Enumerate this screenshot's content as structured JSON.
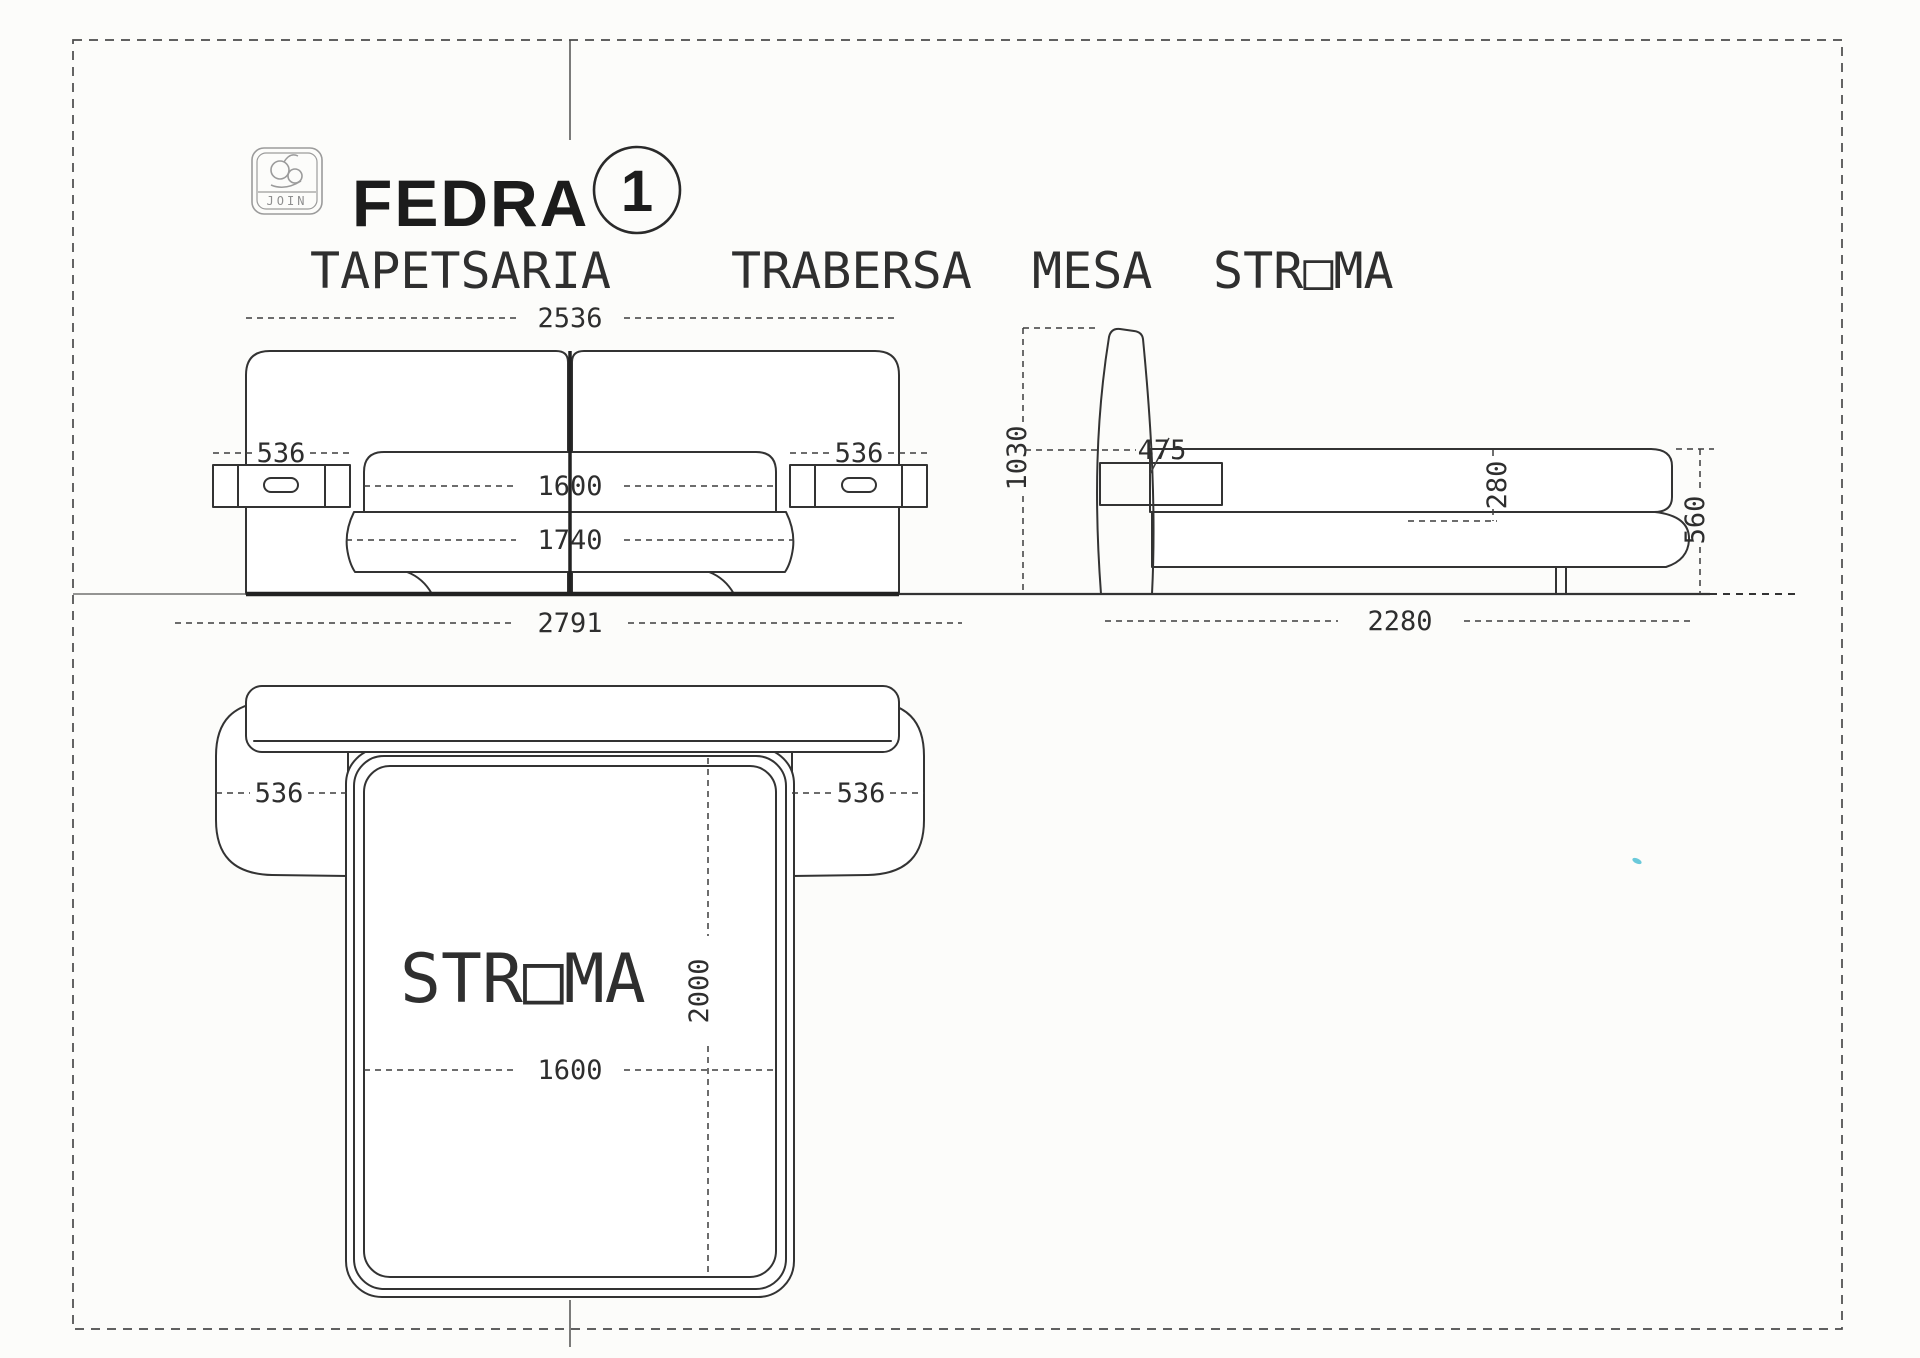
{
  "page": {
    "background": "#fcfcfa",
    "line_color": "#333333"
  },
  "title": {
    "product": "FEDRA",
    "variant_number": "1",
    "logo_brand": "JOIN"
  },
  "subtitle": {
    "word1": "TAPETSARIA",
    "word2": "TRABERSA",
    "word3": "MESA",
    "word4": "STR□MA"
  },
  "front_view": {
    "overall_width": "2536",
    "left_nightstand_width": "536",
    "right_nightstand_width": "536",
    "mattress_width": "1600",
    "base_width": "1740",
    "total_width": "2791"
  },
  "side_view": {
    "headboard_height": "1030",
    "nightstand_depth": "475",
    "mattress_thickness": "280",
    "base_height": "560",
    "bed_length": "2280"
  },
  "plan_view": {
    "mattress_label": "STR□MA",
    "left_table_width": "536",
    "right_table_width": "536",
    "mattress_length": "2000",
    "mattress_width": "1600"
  }
}
